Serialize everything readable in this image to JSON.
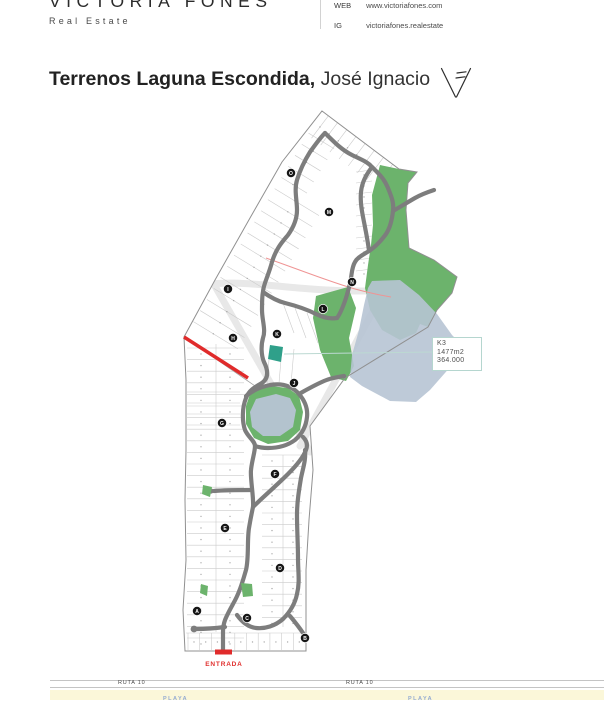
{
  "header": {
    "brand": "VICTORIA FONES",
    "tagline": "Real Estate",
    "contact": [
      {
        "label": "WEB",
        "value": "www.victoriafones.com"
      },
      {
        "label": "IG",
        "value": "victoriafones.realestate"
      }
    ]
  },
  "title": {
    "bold": "Terrenos Laguna Escondida,",
    "regular": " José Ignacio"
  },
  "map": {
    "entrance_label": "ENTRADA",
    "tooltip": {
      "parcel": "K3",
      "area": "1477m2",
      "price": "364.000"
    },
    "markers": [
      {
        "letter": "O",
        "x": 291,
        "y": 173
      },
      {
        "letter": "M",
        "x": 329,
        "y": 212
      },
      {
        "letter": "N",
        "x": 352,
        "y": 282
      },
      {
        "letter": "I",
        "x": 228,
        "y": 289
      },
      {
        "letter": "L",
        "x": 323,
        "y": 309
      },
      {
        "letter": "K",
        "x": 277,
        "y": 334
      },
      {
        "letter": "H",
        "x": 233,
        "y": 338
      },
      {
        "letter": "J",
        "x": 294,
        "y": 383
      },
      {
        "letter": "G",
        "x": 222,
        "y": 423
      },
      {
        "letter": "F",
        "x": 275,
        "y": 474
      },
      {
        "letter": "E",
        "x": 225,
        "y": 528
      },
      {
        "letter": "D",
        "x": 280,
        "y": 568
      },
      {
        "letter": "A",
        "x": 197,
        "y": 611
      },
      {
        "letter": "C",
        "x": 247,
        "y": 618
      },
      {
        "letter": "B",
        "x": 305,
        "y": 638
      }
    ],
    "colors": {
      "road_gray": "#7d7d7d",
      "green_area": "#6cb36c",
      "lake_blue": "#b7c4d4",
      "selected_parcel_teal": "#2fa08a",
      "accent_red": "#e02b2b",
      "tooltip_border": "#b5d6cf",
      "marker_black": "#161616"
    }
  },
  "footer": {
    "route_label": "RUTA 10",
    "beach_label": "PLAYA",
    "beach_band_color": "#fbf7d9",
    "beach_text_color": "#94abd1"
  }
}
